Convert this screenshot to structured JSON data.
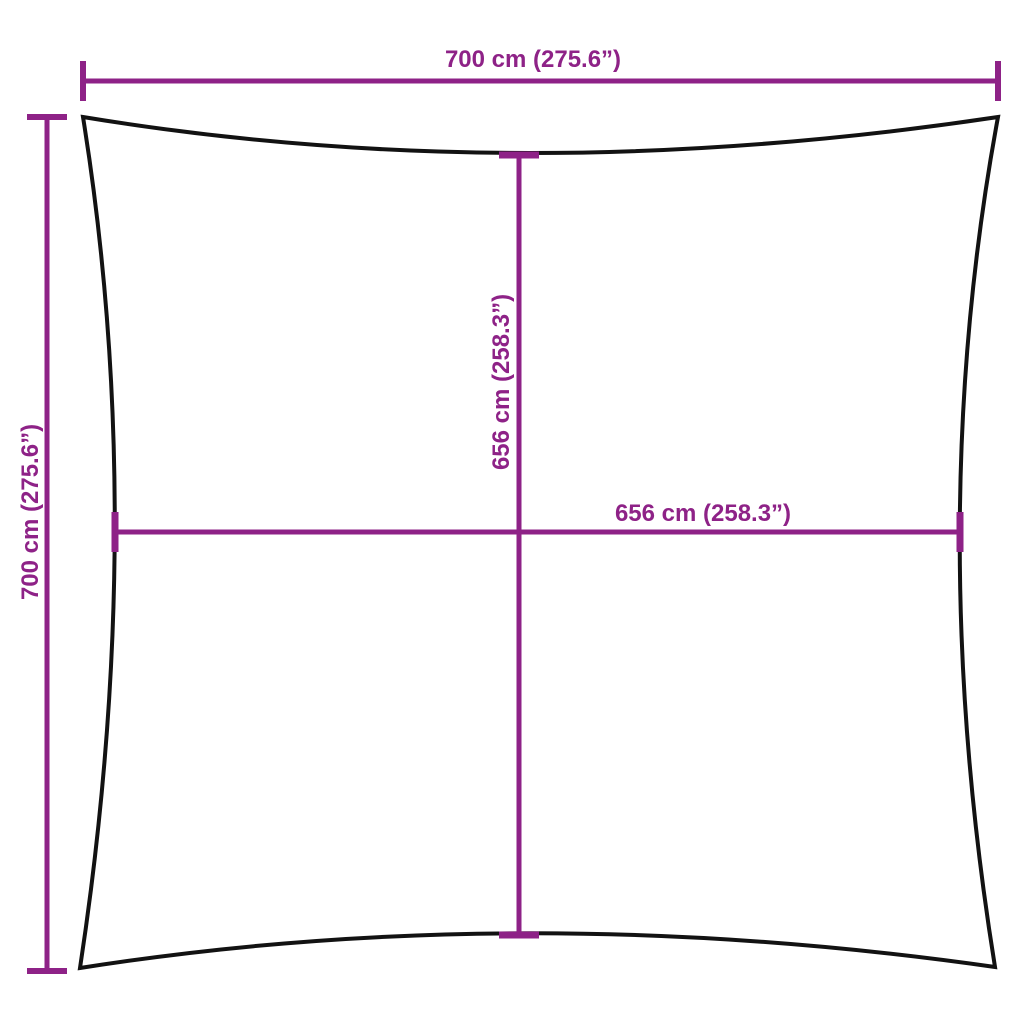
{
  "diagram": {
    "kind": "product-dimension-diagram",
    "colors": {
      "dimension": "#8E2287",
      "outline": "#121212",
      "background": "#FFFFFF"
    },
    "measurements": {
      "outer_width": {
        "cm": 700,
        "inches": 275.6,
        "label": "700 cm (275.6”)"
      },
      "outer_height": {
        "cm": 700,
        "inches": 275.6,
        "label": "700 cm (275.6”)"
      },
      "inner_height": {
        "cm": 656,
        "inches": 258.3,
        "label": "656 cm (258.3”)"
      },
      "inner_width": {
        "cm": 656,
        "inches": 258.3,
        "label": "656 cm (258.3”)"
      }
    }
  }
}
